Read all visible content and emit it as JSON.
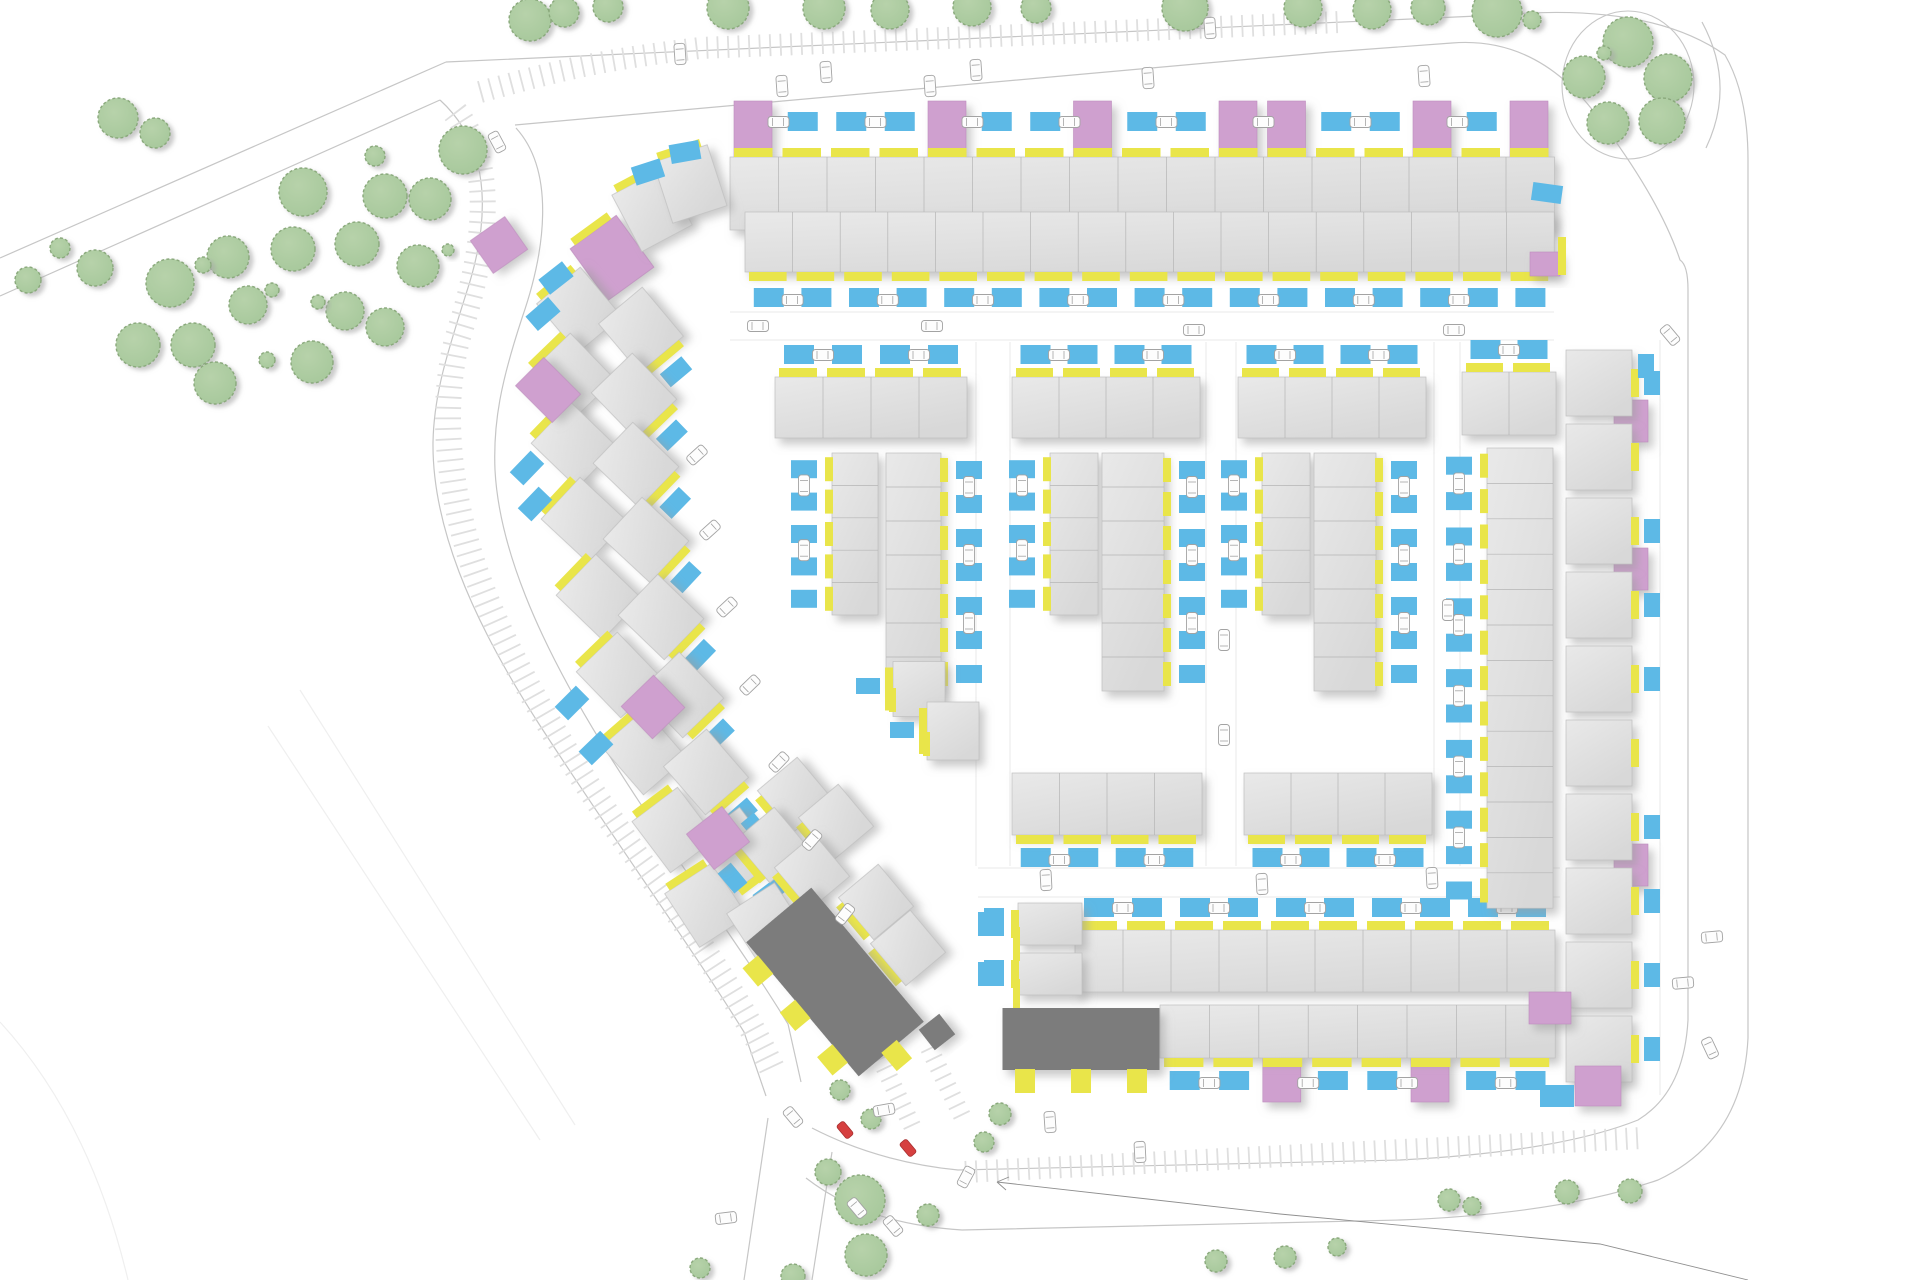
{
  "palette": {
    "house_fill": "#d8d8d8",
    "house_hi": "#e9e9e9",
    "house_edge": "#bfbfbf",
    "yellow": "#e9e54a",
    "blue": "#5db9e6",
    "pink": "#cfa0cf",
    "pink_edge": "#bd8cbd",
    "dark": "#7b7b7b",
    "tree_fill": "#a5c79a",
    "tree_edge": "#8aa97c",
    "road": "#c6c6c6",
    "lot": "#e8e8e8",
    "faint": "#efefef",
    "hatch": "#dfdfdf",
    "car_fill": "#fdfdfd",
    "car_edge": "#a3a3a3",
    "car_red": "#d64040",
    "shadow": "#9d9d9d",
    "fence": "#d9d9d9",
    "boundary": "#8f8f8f"
  },
  "canvas": {
    "w": 1920,
    "h": 1280
  },
  "roads": {
    "edges": [
      "M0,258 L446,62",
      "M0,296 L440,100",
      "M446,62 L1500,15 Q1650,2 1725,55 Q1748,95 1748,160 L1748,1038",
      "M515,125 L1330,52 L1452,43 Q1540,36 1600,120 Q1660,200 1680,260 Q1688,265 1688,290 L1688,1020",
      "M440,100 C495,150 488,228 466,294 C447,354 434,394 433,442 C432,522 468,614 539,724 C610,834 688,942 744,1032 L766,1096",
      "M516,128 C556,172 545,252 522,318 C501,382 493,422 495,470 C499,547 537,638 601,742 C665,846 734,936 788,1024 L801,1082",
      "M1702,22 Q1736,85 1706,148",
      "M1748,1038 Q1743,1140 1658,1180 Q1560,1214 1400,1220 L962,1230 Q865,1224 806,1178",
      "M1688,1020 Q1684,1092 1638,1120 Q1558,1152 1400,1160 L958,1170 Q878,1162 812,1128",
      "M768,1118 L744,1280",
      "M832,1152 L812,1280"
    ],
    "oval": {
      "cx": 1628,
      "cy": 85,
      "rx": 66,
      "ry": 74
    },
    "lot_lines": [
      "M730,312 L1554,312",
      "M730,340 L1554,340",
      "M978,868 L1560,868",
      "M978,897 L1560,897",
      "M976,342 L976,866",
      "M1010,342 L1010,866",
      "M1206,342 L1206,866",
      "M1236,342 L1236,866",
      "M1434,342 L1434,866",
      "M1460,342 L1460,866",
      "M1660,340 L1660,1095"
    ],
    "faint_lines": [
      "M300,690 L575,1125",
      "M268,726 L540,1140",
      "M0,1022 Q90,1120 128,1280"
    ],
    "hatch_bands": [
      {
        "d": "M480,92 C560,70 600,60 700,48 L1340,22",
        "w": 22
      },
      {
        "d": "M455,112 C502,172 480,268 457,340 C442,400 446,470 467,545 C496,646 568,763 651,876 C715,963 749,1018 775,1075",
        "w": 26
      },
      {
        "d": "M965,1172 L1642,1138",
        "w": 22
      },
      {
        "d": "M880,1058 L914,1130",
        "w": 18
      },
      {
        "d": "M929,1048 L965,1122",
        "w": 18
      }
    ],
    "boundary": {
      "d": "M997,1182 L1280,1214 L1600,1244 L1748,1280",
      "arrow": "M997,1182 l12,-5 M997,1182 l9,8"
    }
  },
  "trees": [
    [
      118,
      118,
      20
    ],
    [
      155,
      133,
      15
    ],
    [
      303,
      192,
      24
    ],
    [
      385,
      196,
      22
    ],
    [
      430,
      199,
      21
    ],
    [
      463,
      150,
      24
    ],
    [
      375,
      156,
      10
    ],
    [
      228,
      257,
      21
    ],
    [
      170,
      283,
      24
    ],
    [
      293,
      249,
      22
    ],
    [
      357,
      244,
      22
    ],
    [
      418,
      266,
      21
    ],
    [
      248,
      305,
      19
    ],
    [
      345,
      311,
      19
    ],
    [
      385,
      327,
      19
    ],
    [
      138,
      345,
      22
    ],
    [
      193,
      345,
      22
    ],
    [
      215,
      383,
      21
    ],
    [
      312,
      362,
      21
    ],
    [
      203,
      265,
      8
    ],
    [
      272,
      290,
      7
    ],
    [
      267,
      360,
      8
    ],
    [
      318,
      302,
      7
    ],
    [
      448,
      250,
      6
    ],
    [
      95,
      268,
      18
    ],
    [
      28,
      280,
      13
    ],
    [
      60,
      248,
      10
    ],
    [
      530,
      20,
      21
    ],
    [
      564,
      12,
      15
    ],
    [
      608,
      7,
      15
    ],
    [
      728,
      8,
      21
    ],
    [
      824,
      8,
      21
    ],
    [
      890,
      10,
      19
    ],
    [
      972,
      7,
      19
    ],
    [
      1036,
      8,
      15
    ],
    [
      1185,
      8,
      23
    ],
    [
      1303,
      8,
      19
    ],
    [
      1372,
      10,
      19
    ],
    [
      1428,
      8,
      17
    ],
    [
      1497,
      12,
      25
    ],
    [
      1532,
      20,
      9
    ],
    [
      1628,
      42,
      25
    ],
    [
      1584,
      77,
      21
    ],
    [
      1668,
      78,
      24
    ],
    [
      1608,
      123,
      21
    ],
    [
      1662,
      121,
      23
    ],
    [
      1604,
      53,
      7
    ],
    [
      828,
      1172,
      13
    ],
    [
      860,
      1200,
      25
    ],
    [
      866,
      1255,
      21
    ],
    [
      928,
      1215,
      11
    ],
    [
      984,
      1142,
      10
    ],
    [
      1000,
      1114,
      11
    ],
    [
      840,
      1090,
      10
    ],
    [
      871,
      1119,
      10
    ],
    [
      1216,
      1261,
      11
    ],
    [
      1285,
      1257,
      11
    ],
    [
      1337,
      1247,
      9
    ],
    [
      1449,
      1200,
      11
    ],
    [
      1472,
      1206,
      9
    ],
    [
      1567,
      1192,
      12
    ],
    [
      1630,
      1191,
      12
    ],
    [
      793,
      1276,
      12
    ],
    [
      700,
      1268,
      10
    ]
  ],
  "h_rows": [
    {
      "id": "north-terrace-row-1",
      "x": 730,
      "y": 157,
      "pitch": 48.5,
      "count": 17,
      "h": 73,
      "front": "top",
      "pad_gap": 26,
      "pinks": [
        0,
        4,
        7,
        10,
        11,
        14,
        16
      ]
    },
    {
      "id": "north-terrace-row-2",
      "x": 745,
      "y": 212,
      "pitch": 47.6,
      "count": 17,
      "h": 60,
      "front": "bottom",
      "pad_gap": 16,
      "pinks": []
    },
    {
      "id": "block-a-top-row",
      "x": 775,
      "y": 377,
      "pitch": 48,
      "count": 4,
      "h": 61,
      "front": "top",
      "pad_gap": 13,
      "pinks": []
    },
    {
      "id": "block-b-top-row",
      "x": 1012,
      "y": 377,
      "pitch": 47,
      "count": 4,
      "h": 61,
      "front": "top",
      "pad_gap": 13,
      "pinks": []
    },
    {
      "id": "block-c-top-row",
      "x": 1238,
      "y": 377,
      "pitch": 47,
      "count": 4,
      "h": 61,
      "front": "top",
      "pad_gap": 13,
      "pinks": []
    },
    {
      "id": "block-d-top-row",
      "x": 1462,
      "y": 372,
      "pitch": 47,
      "count": 2,
      "h": 63,
      "front": "top",
      "pad_gap": 13,
      "pinks": []
    },
    {
      "id": "block-b-bottom-row",
      "x": 1012,
      "y": 773,
      "pitch": 47.5,
      "count": 4,
      "h": 62,
      "front": "bottom",
      "pad_gap": 13,
      "pinks": []
    },
    {
      "id": "block-c-bottom-row",
      "x": 1244,
      "y": 773,
      "pitch": 47,
      "count": 4,
      "h": 62,
      "front": "bottom",
      "pad_gap": 13,
      "pinks": []
    },
    {
      "id": "south-block-north-row",
      "x": 1075,
      "y": 930,
      "pitch": 48,
      "count": 10,
      "h": 62,
      "front": "top",
      "pad_gap": 13,
      "pinks": []
    },
    {
      "id": "south-block-south-row",
      "x": 1160,
      "y": 1005,
      "pitch": 49.4,
      "count": 8,
      "h": 53,
      "front": "bottom",
      "pad_gap": 13,
      "pinks": [
        2,
        5
      ]
    }
  ],
  "v_rows": [
    {
      "id": "block-a-terrace-west",
      "x": 832,
      "y": 453,
      "w": 46,
      "pitch": 32.4,
      "count": 5,
      "front": "left"
    },
    {
      "id": "block-a-terrace-east",
      "x": 886,
      "y": 453,
      "w": 55,
      "pitch": 34,
      "count": 7,
      "front": "right"
    },
    {
      "id": "block-b-terrace-west",
      "x": 1050,
      "y": 453,
      "w": 48,
      "pitch": 32.4,
      "count": 5,
      "front": "left"
    },
    {
      "id": "block-b-terrace-east",
      "x": 1102,
      "y": 453,
      "w": 62,
      "pitch": 34,
      "count": 7,
      "front": "right"
    },
    {
      "id": "block-c-terrace-west",
      "x": 1262,
      "y": 453,
      "w": 48,
      "pitch": 32.4,
      "count": 5,
      "front": "left"
    },
    {
      "id": "block-c-terrace-east",
      "x": 1314,
      "y": 453,
      "w": 62,
      "pitch": 34,
      "count": 7,
      "front": "right"
    },
    {
      "id": "block-d-terrace",
      "x": 1487,
      "y": 448,
      "w": 66,
      "pitch": 35.4,
      "count": 13,
      "front": "left"
    },
    {
      "id": "east-column",
      "x": 1566,
      "y": 350,
      "w": 66,
      "pitch": 74,
      "count": 10,
      "front": "right",
      "detached": true,
      "pinks": [
        0,
        2,
        6
      ],
      "pad_skip": [
        1,
        5
      ]
    },
    {
      "id": "south-block-west-col",
      "x": 1018,
      "y": 903,
      "w": 64,
      "pitch": 50,
      "count": 2,
      "front": "left",
      "detached": true,
      "pinks": [],
      "pad_skip": []
    }
  ],
  "rot_houses": [
    {
      "x": 612,
      "y": 258,
      "w": 57,
      "h": 64,
      "rot": -36,
      "front": "top",
      "pad": false,
      "color": "pink"
    },
    {
      "x": 652,
      "y": 210,
      "w": 57,
      "h": 64,
      "rot": -28,
      "front": "top",
      "pad": false
    },
    {
      "x": 690,
      "y": 184,
      "w": 57,
      "h": 64,
      "rot": -18,
      "front": "top",
      "pad": false
    },
    {
      "x": 579,
      "y": 310,
      "w": 57,
      "h": 64,
      "rot": -40,
      "front": "top",
      "pad": false
    },
    {
      "x": 572,
      "y": 376,
      "w": 57,
      "h": 64,
      "rot": -44,
      "front": "top",
      "pad": false
    },
    {
      "x": 574,
      "y": 445,
      "w": 57,
      "h": 64,
      "rot": -46,
      "front": "top",
      "pad": false
    },
    {
      "x": 584,
      "y": 520,
      "w": 57,
      "h": 64,
      "rot": -47,
      "front": "top",
      "pad": false
    },
    {
      "x": 599,
      "y": 597,
      "w": 57,
      "h": 64,
      "rot": -46,
      "front": "top",
      "pad": false
    },
    {
      "x": 619,
      "y": 675,
      "w": 57,
      "h": 64,
      "rot": -44,
      "front": "top",
      "pad": false
    },
    {
      "x": 644,
      "y": 752,
      "w": 57,
      "h": 64,
      "rot": -41,
      "front": "top",
      "pad": false
    },
    {
      "x": 674,
      "y": 830,
      "w": 57,
      "h": 64,
      "rot": -37,
      "front": "top",
      "pad": false
    },
    {
      "x": 706,
      "y": 905,
      "w": 57,
      "h": 64,
      "rot": -33,
      "front": "top",
      "pad": false
    },
    {
      "x": 641,
      "y": 330,
      "w": 57,
      "h": 64,
      "rot": -40,
      "front": "bottom",
      "pad": true
    },
    {
      "x": 634,
      "y": 396,
      "w": 57,
      "h": 64,
      "rot": -44,
      "front": "bottom",
      "pad": true
    },
    {
      "x": 636,
      "y": 465,
      "w": 57,
      "h": 64,
      "rot": -46,
      "front": "bottom",
      "pad": true
    },
    {
      "x": 646,
      "y": 540,
      "w": 57,
      "h": 64,
      "rot": -47,
      "front": "bottom",
      "pad": true
    },
    {
      "x": 661,
      "y": 617,
      "w": 57,
      "h": 64,
      "rot": -46,
      "front": "bottom",
      "pad": true
    },
    {
      "x": 681,
      "y": 695,
      "w": 57,
      "h": 64,
      "rot": -44,
      "front": "bottom",
      "pad": true
    },
    {
      "x": 706,
      "y": 772,
      "w": 57,
      "h": 64,
      "rot": -41,
      "front": "bottom",
      "pad": true
    },
    {
      "x": 736,
      "y": 850,
      "w": 57,
      "h": 64,
      "rot": -37,
      "front": "bottom",
      "pad": true
    },
    {
      "x": 768,
      "y": 925,
      "w": 57,
      "h": 64,
      "rot": -33,
      "front": "bottom",
      "pad": true
    },
    {
      "x": 795,
      "y": 795,
      "w": 52,
      "h": 55,
      "rot": -40,
      "front": "left",
      "pad": true
    },
    {
      "x": 836,
      "y": 822,
      "w": 52,
      "h": 55,
      "rot": -40,
      "front": "left",
      "pad": false
    },
    {
      "x": 772,
      "y": 845,
      "w": 52,
      "h": 55,
      "rot": -40,
      "front": "left",
      "pad": true
    },
    {
      "x": 812,
      "y": 872,
      "w": 52,
      "h": 55,
      "rot": -40,
      "front": "left",
      "pad": false
    },
    {
      "x": 876,
      "y": 902,
      "w": 52,
      "h": 55,
      "rot": -40,
      "front": "left",
      "pad": true
    },
    {
      "x": 908,
      "y": 948,
      "w": 52,
      "h": 55,
      "rot": -40,
      "front": "left",
      "pad": false
    },
    {
      "x": 919,
      "y": 689,
      "w": 52,
      "h": 55,
      "rot": 0,
      "front": "left",
      "pad": false
    },
    {
      "x": 953,
      "y": 731,
      "w": 52,
      "h": 58,
      "rot": 0,
      "front": "left",
      "pad": false
    }
  ],
  "pink_blocks": [
    [
      499,
      245,
      42,
      40,
      -35
    ],
    [
      548,
      390,
      40,
      52,
      -45
    ],
    [
      653,
      707,
      45,
      45,
      -44
    ],
    [
      718,
      838,
      45,
      45,
      -38
    ],
    [
      1598,
      1086,
      46,
      40,
      0
    ],
    [
      1550,
      1008,
      42,
      32,
      0
    ],
    [
      1545,
      264,
      30,
      24,
      0
    ]
  ],
  "extra_pads": [
    [
      648,
      172,
      30,
      19,
      -18
    ],
    [
      685,
      152,
      30,
      19,
      -10
    ],
    [
      556,
      278,
      30,
      19,
      -38
    ],
    [
      543,
      314,
      30,
      19,
      -41
    ],
    [
      527,
      468,
      30,
      19,
      -46
    ],
    [
      535,
      504,
      30,
      19,
      -46
    ],
    [
      572,
      703,
      30,
      19,
      -45
    ],
    [
      596,
      748,
      30,
      19,
      -44
    ],
    [
      1547,
      193,
      30,
      18,
      8
    ],
    [
      994,
      922,
      20,
      28,
      0
    ],
    [
      994,
      973,
      20,
      26,
      0
    ],
    [
      868,
      686,
      24,
      16,
      0
    ],
    [
      902,
      730,
      24,
      16,
      0
    ],
    [
      1557,
      1096,
      34,
      22,
      0
    ],
    [
      1646,
      366,
      16,
      24,
      0
    ]
  ],
  "extra_yellow": [
    [
      1558,
      237,
      8,
      38,
      0
    ],
    [
      1013,
      927,
      7,
      34,
      0
    ],
    [
      1013,
      979,
      7,
      30,
      0
    ],
    [
      889,
      688,
      7,
      24,
      0
    ],
    [
      923,
      732,
      7,
      24,
      0
    ]
  ],
  "dark_buildings": [
    {
      "x": 835,
      "y": 982,
      "w": 85,
      "h": 175,
      "rot": -40,
      "stubs": [
        [
          -52,
          -58
        ],
        [
          -52,
          0
        ],
        [
          -52,
          58
        ],
        [
          0,
          96
        ]
      ]
    },
    {
      "x": 1081,
      "y": 1039,
      "w": 157,
      "h": 62,
      "rot": 0,
      "stubs": [
        [
          -56,
          42
        ],
        [
          0,
          42
        ],
        [
          56,
          42
        ]
      ]
    },
    {
      "x": 937,
      "y": 1032,
      "w": 26,
      "h": 26,
      "rot": -38,
      "stubs": []
    }
  ],
  "cars": {
    "white": [
      [
        782,
        86,
        -4
      ],
      [
        826,
        72,
        -4
      ],
      [
        930,
        86,
        -4
      ],
      [
        976,
        70,
        -4
      ],
      [
        1148,
        78,
        -4
      ],
      [
        1424,
        76,
        -4
      ],
      [
        680,
        54,
        -4
      ],
      [
        1210,
        28,
        -4
      ],
      [
        497,
        142,
        -28
      ],
      [
        758,
        326,
        90
      ],
      [
        932,
        326,
        90
      ],
      [
        1194,
        330,
        90
      ],
      [
        1454,
        330,
        90
      ],
      [
        697,
        455,
        48
      ],
      [
        710,
        530,
        48
      ],
      [
        727,
        607,
        47
      ],
      [
        750,
        685,
        46
      ],
      [
        779,
        762,
        44
      ],
      [
        812,
        840,
        41
      ],
      [
        845,
        914,
        38
      ],
      [
        1224,
        640,
        0
      ],
      [
        1224,
        735,
        0
      ],
      [
        1448,
        610,
        0
      ],
      [
        1046,
        880,
        -3
      ],
      [
        1262,
        884,
        -3
      ],
      [
        1432,
        878,
        -3
      ],
      [
        793,
        1117,
        -40
      ],
      [
        884,
        1110,
        80
      ],
      [
        857,
        1208,
        -40
      ],
      [
        893,
        1226,
        -40
      ],
      [
        966,
        1177,
        28
      ],
      [
        1050,
        1122,
        -4
      ],
      [
        1140,
        1152,
        -3
      ],
      [
        1670,
        335,
        -40
      ],
      [
        1683,
        983,
        85
      ],
      [
        1712,
        937,
        85
      ],
      [
        1710,
        1048,
        -25
      ],
      [
        726,
        1218,
        83
      ]
    ],
    "red": [
      [
        845,
        1130,
        -40
      ],
      [
        908,
        1148,
        -40
      ]
    ]
  }
}
